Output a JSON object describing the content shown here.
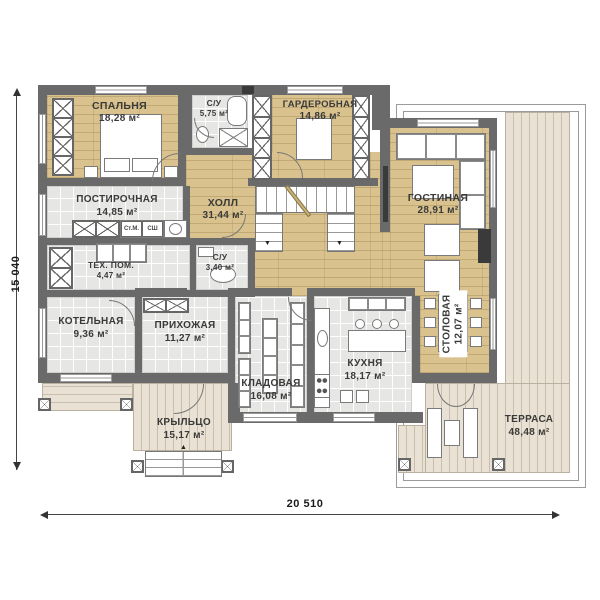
{
  "dimensions": {
    "width_total": "20 510",
    "height_total": "15 040"
  },
  "rooms": [
    {
      "name": "СПАЛЬНЯ",
      "area": "18,28 м²"
    },
    {
      "name": "С/У",
      "area": "5,75 м²"
    },
    {
      "name": "ГАРДЕРОБНАЯ",
      "area": "14,86 м²"
    },
    {
      "name": "ГОСТИНАЯ",
      "area": "28,91 м²"
    },
    {
      "name": "ПОСТИРОЧНАЯ",
      "area": "14,85 м²"
    },
    {
      "name": "ХОЛЛ",
      "area": "31,44 м²"
    },
    {
      "name": "ТЕХ. ПОМ.",
      "area": "4,47 м²"
    },
    {
      "name": "С/У",
      "area": "3,40 м²"
    },
    {
      "name": "КОТЕЛЬНАЯ",
      "area": "9,36 м²"
    },
    {
      "name": "ПРИХОЖАЯ",
      "area": "11,27 м²"
    },
    {
      "name": "КЛАДОВАЯ",
      "area": "16,08 м²"
    },
    {
      "name": "КУХНЯ",
      "area": "18,17 м²"
    },
    {
      "name": "СТОЛОВАЯ",
      "area": "12,07 м²"
    },
    {
      "name": "КРЫЛЬЦО",
      "area": "15,17 м²"
    },
    {
      "name": "ТЕРРАСА",
      "area": "48,48 м²"
    }
  ],
  "appliances": {
    "washing_machine": "Ст.М.",
    "dryer": "СШ"
  },
  "colors": {
    "wall": "#6a6a6a",
    "wood_floor": "#d9c28d",
    "tile_floor": "#e6e6e4",
    "deck": "#e9e1d3"
  }
}
